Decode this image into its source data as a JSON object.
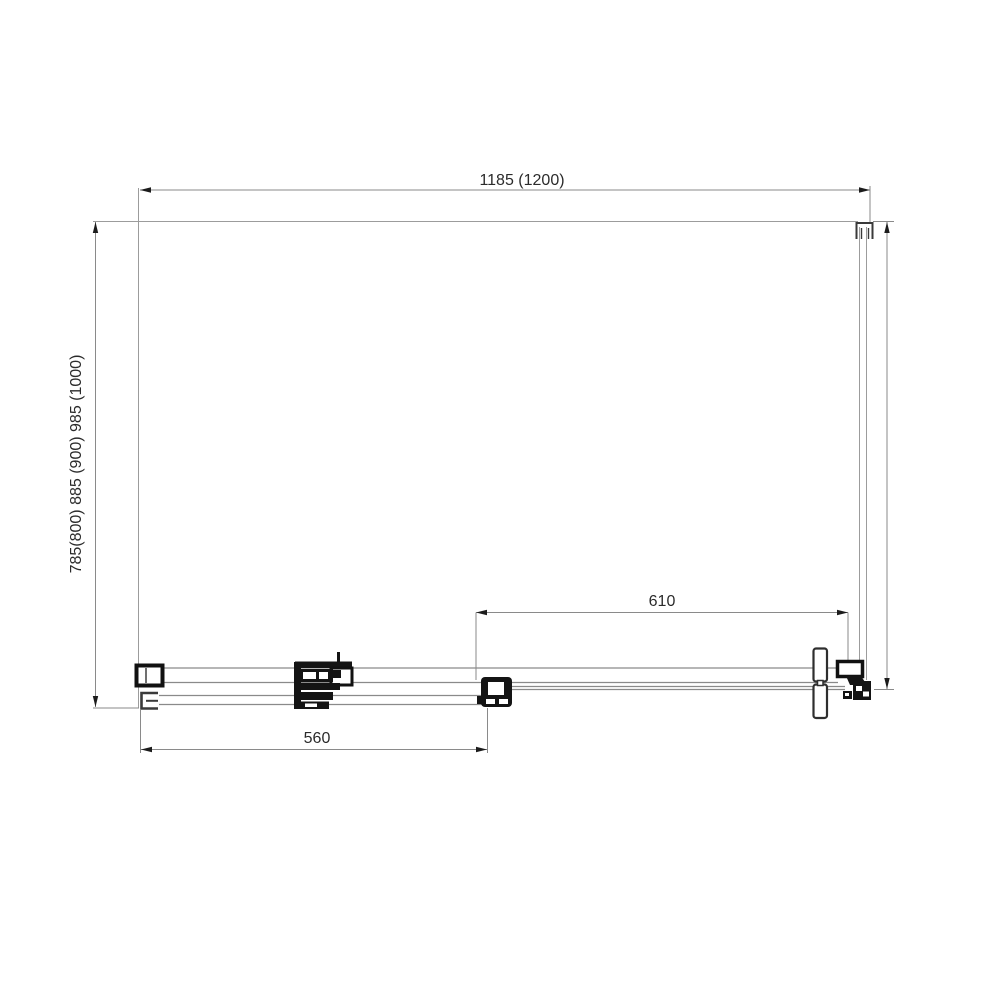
{
  "drawing": {
    "type": "shower-enclosure-plan-view",
    "dimensions": {
      "width_label": "1185 (1200)",
      "depth_label": "785(800) 885 (900) 985 (1000)",
      "opening_label": "610",
      "door_label": "560"
    },
    "colors": {
      "background": "#ffffff",
      "construction_line": "#9c9c9c",
      "dimension_line": "#8a8a8a",
      "hardware": "#141414",
      "text": "#2b2b2b"
    }
  }
}
